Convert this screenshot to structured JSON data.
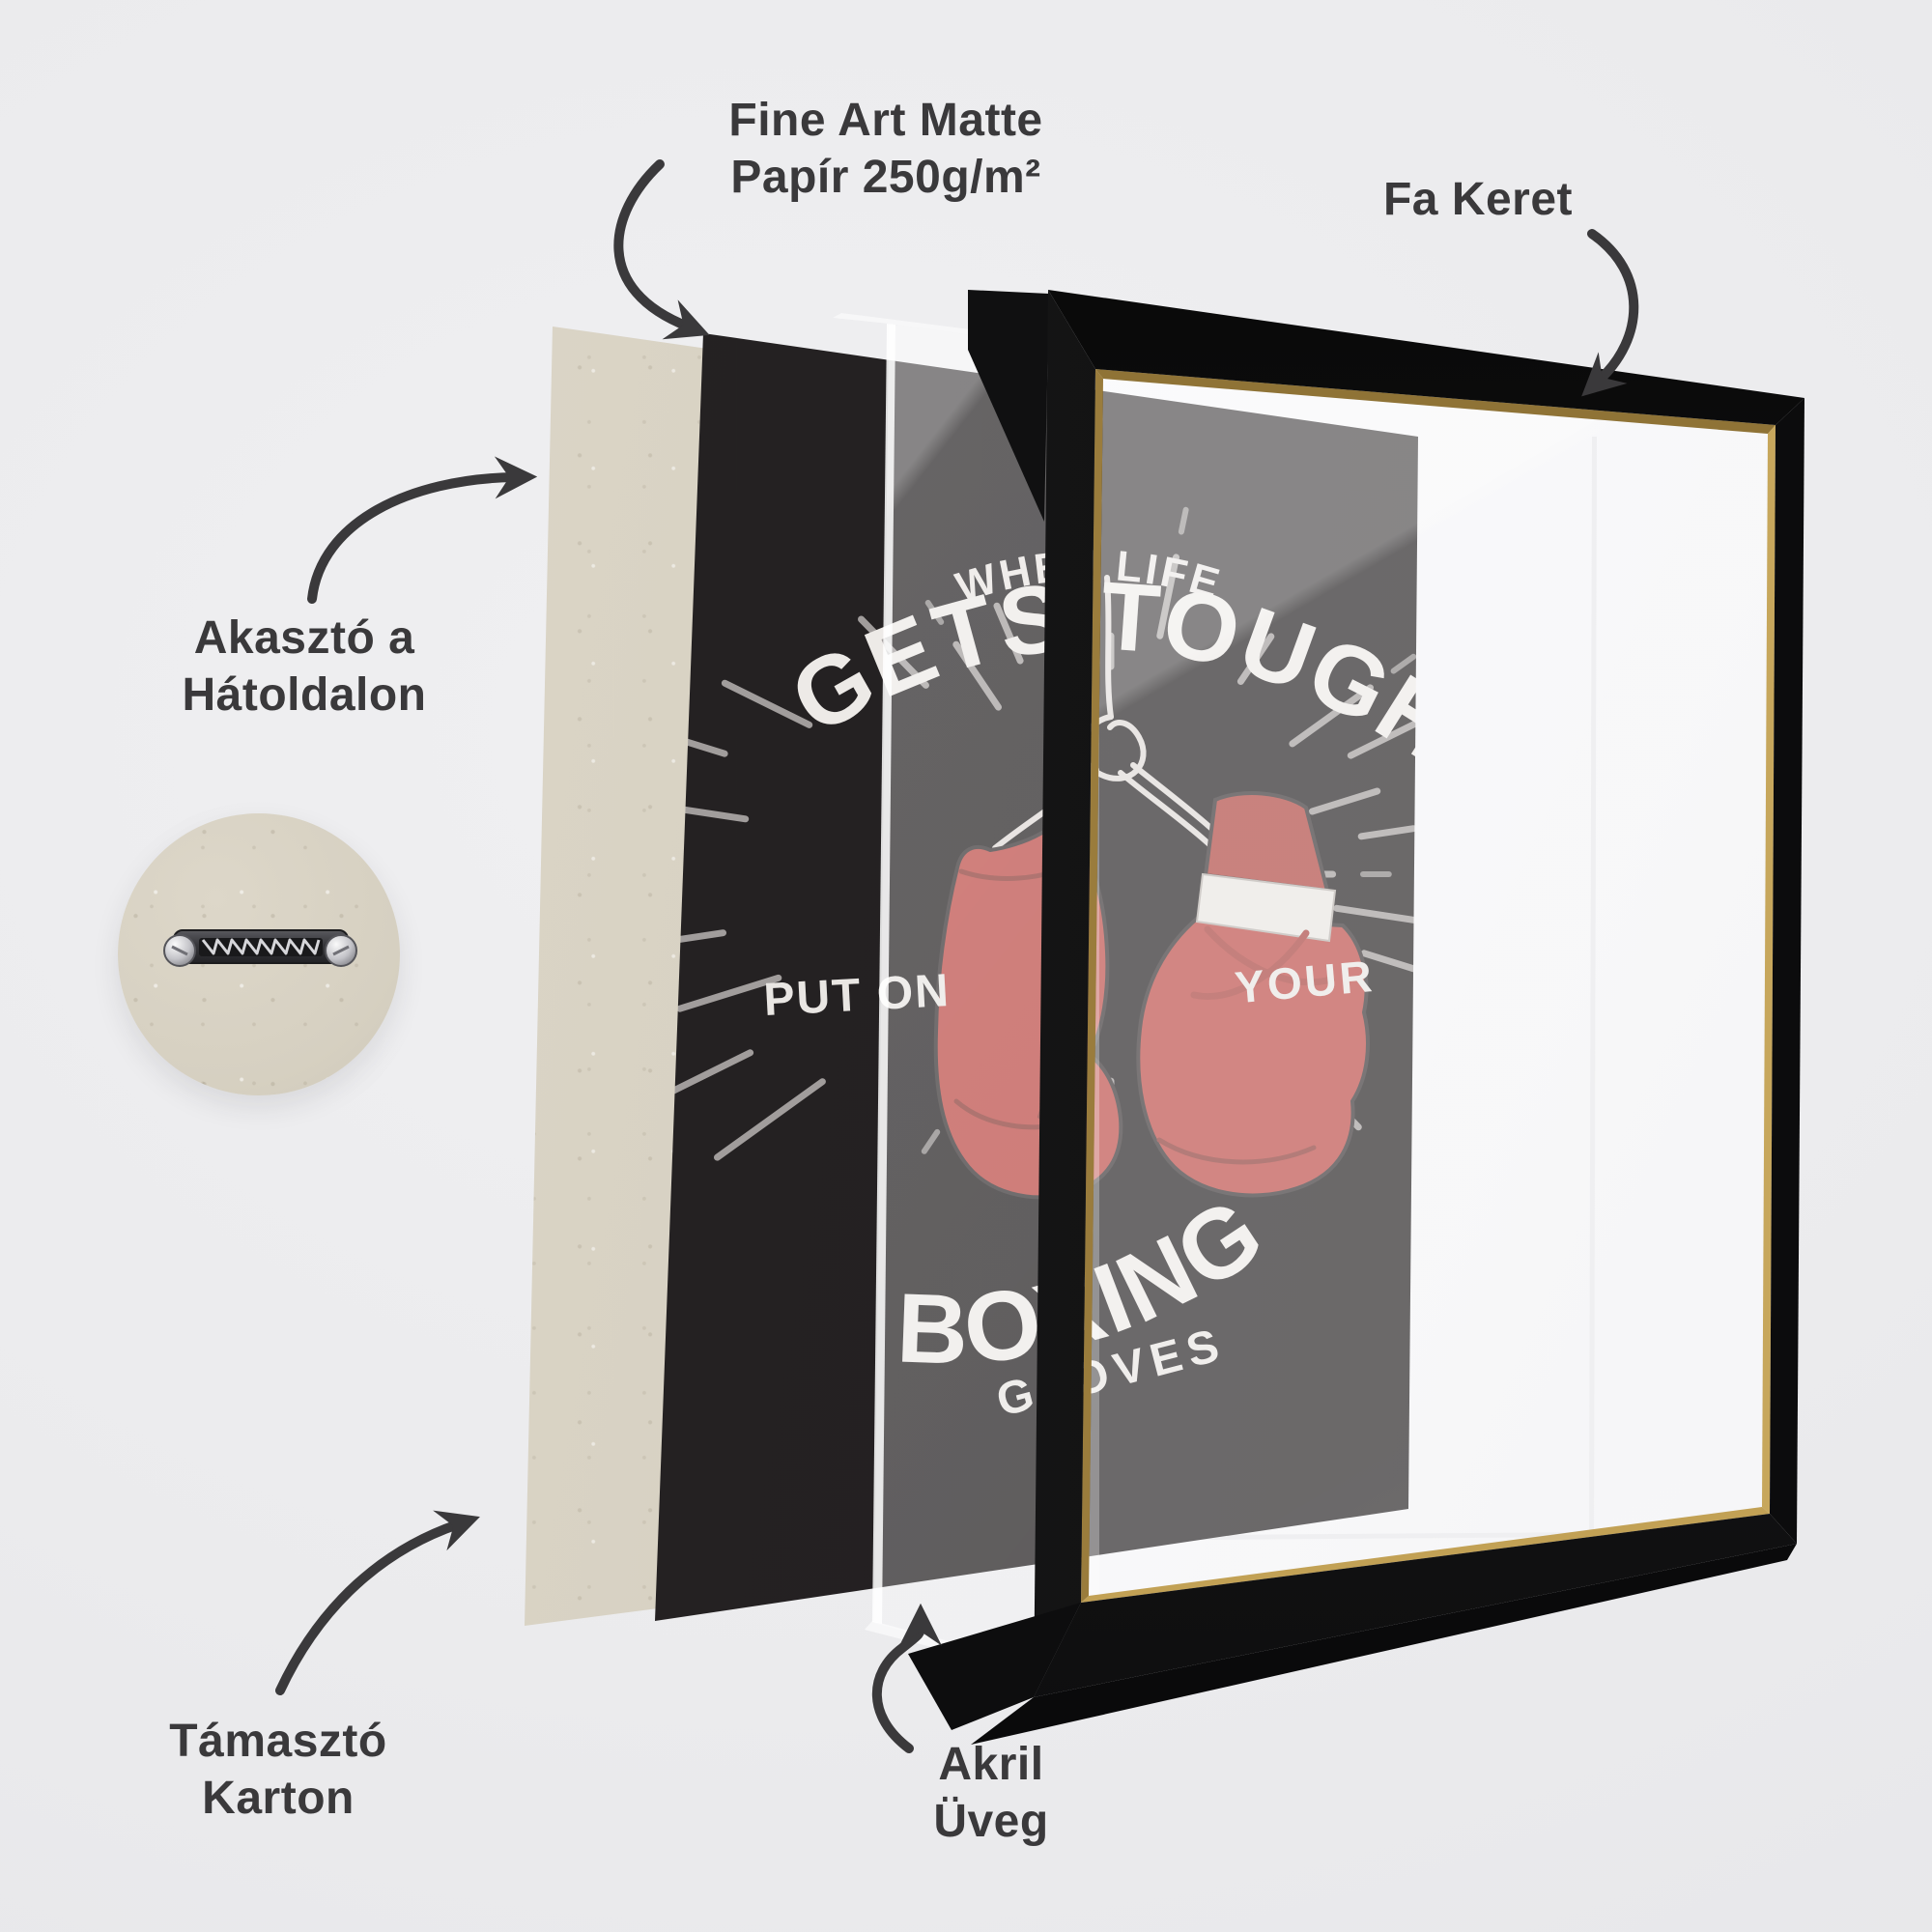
{
  "page": {
    "background_color": "#ebebed",
    "description_language": "hu"
  },
  "labels": {
    "paper": {
      "line1": "Fine Art Matte",
      "line2": "Papír 250g/m²"
    },
    "frame": {
      "text": "Fa Keret"
    },
    "hanger": {
      "line1": "Akasztó a",
      "line2": "Hátoldalon"
    },
    "backing": {
      "line1": "Támasztó",
      "line2": "Karton"
    },
    "acrylic": {
      "line1": "Akril",
      "line2": "Üveg"
    }
  },
  "poster_art": {
    "arc_text_small_top": "WHEN LIFE",
    "arc_text_big_top": "GETS TOUGH",
    "text_mid_left": "PUT ON",
    "text_mid_right": "YOUR",
    "arc_text_big_bottom": "BOXING",
    "arc_text_small_bottom": "GLOVES"
  },
  "colors": {
    "label": "#3a393b",
    "arrow": "#3a393b",
    "poster_background": "#242122",
    "poster_text": "#e9e6e3",
    "glove_red": "#bc4b46",
    "glove_band_white": "#e8e5e1",
    "ray_gray": "#bdb9b7",
    "frame_black": "#151516",
    "frame_gold_lip": "#b08d46",
    "cardboard_beige": "#d6d0c1",
    "mat_white": "#f7f7f9"
  }
}
